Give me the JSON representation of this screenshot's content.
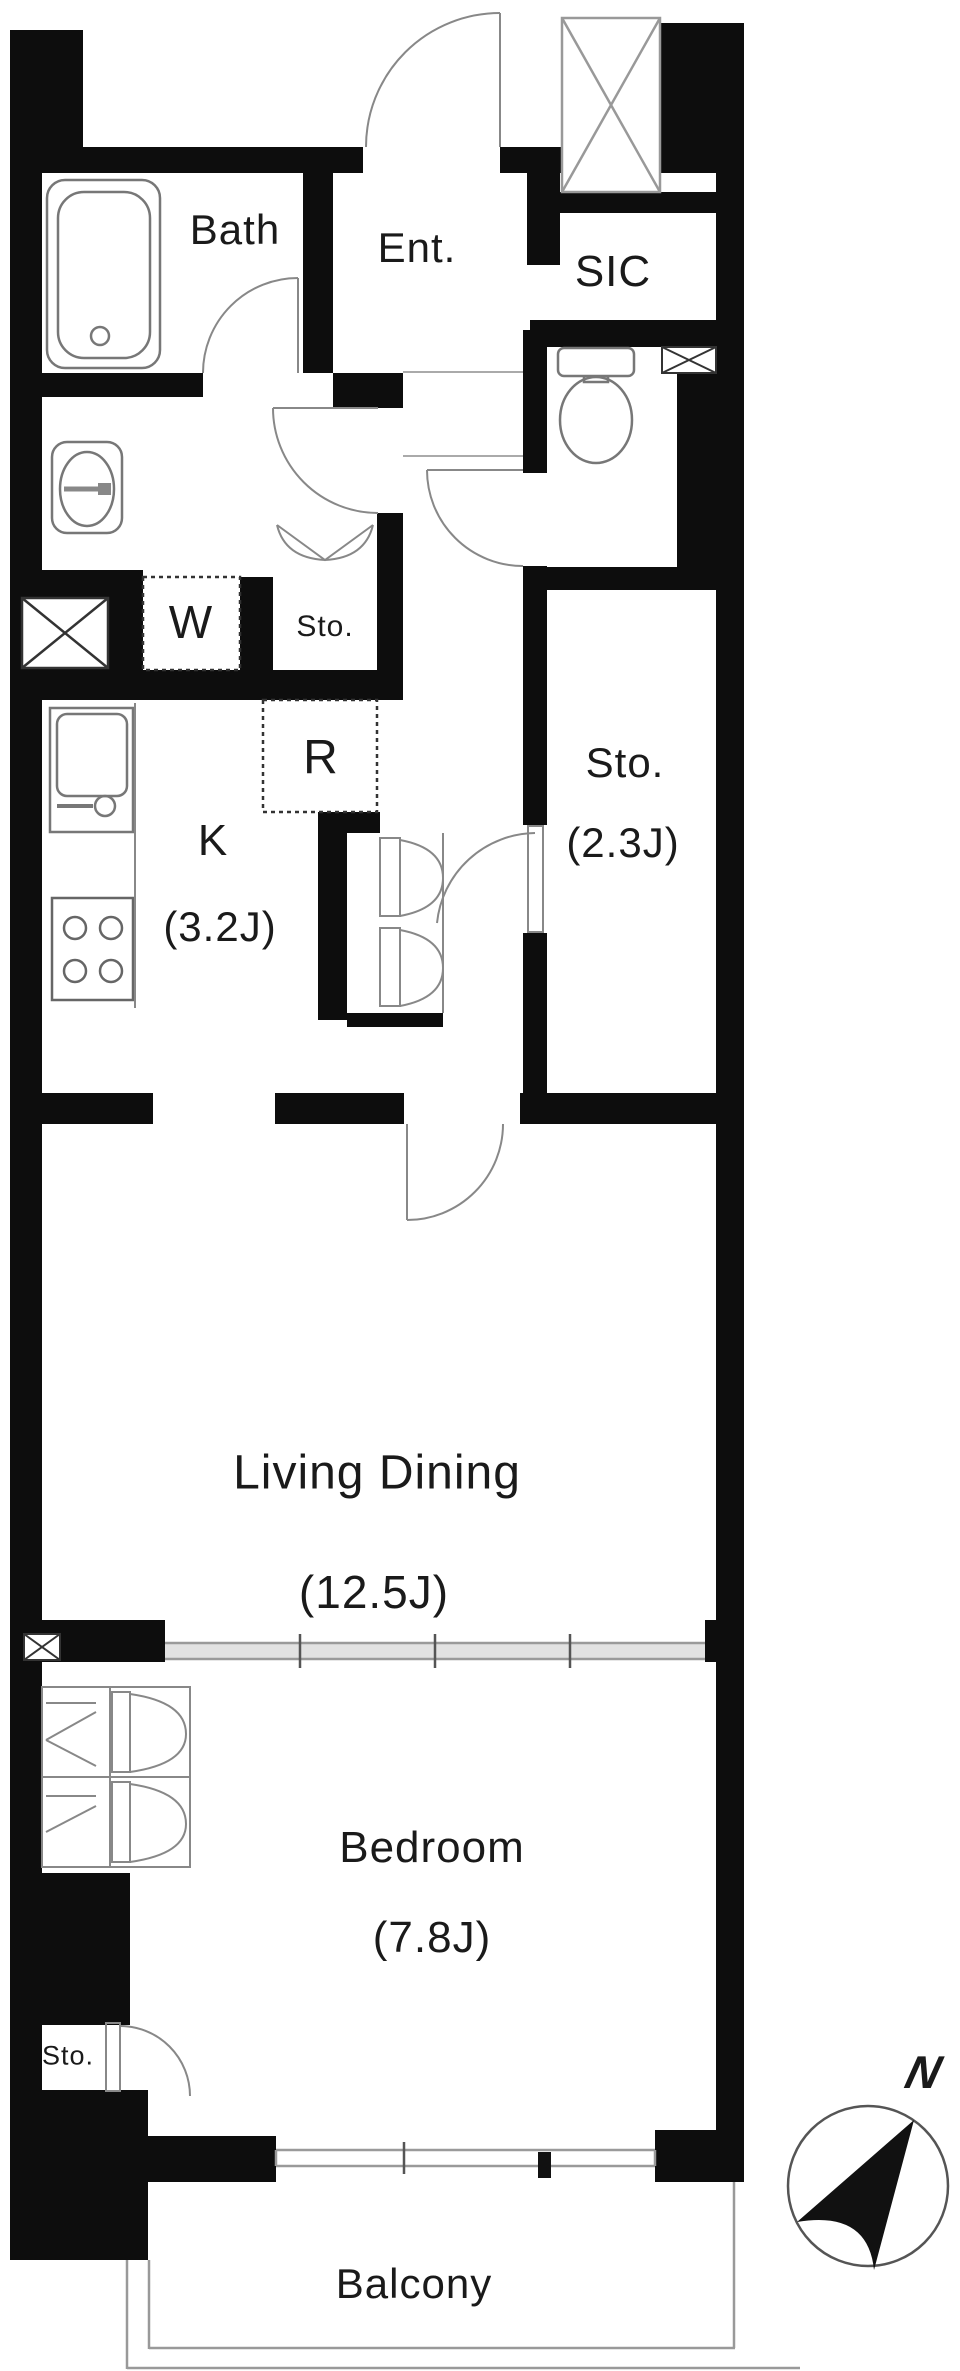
{
  "plan": {
    "title": "1LDK apartment floor plan",
    "rooms": {
      "bath": {
        "label": "Bath"
      },
      "entrance": {
        "label": "Ent."
      },
      "shoe_closet": {
        "label": "SIC"
      },
      "washer_spot": {
        "label": "W"
      },
      "hall_storage": {
        "label": "Sto."
      },
      "fridge_spot": {
        "label": "R"
      },
      "kitchen": {
        "label": "K",
        "size": "(3.2J)"
      },
      "main_storage": {
        "label": "Sto.",
        "size": "(2.3J)"
      },
      "living_dining": {
        "label": "Living Dining",
        "size": "(12.5J)"
      },
      "bedroom": {
        "label": "Bedroom",
        "size": "(7.8J)"
      },
      "bedroom_storage": {
        "label": "Sto."
      },
      "balcony": {
        "label": "Balcony"
      }
    },
    "compass": {
      "label": "N"
    },
    "colors": {
      "wall": "#0d0d0d",
      "line": "#777777",
      "text": "#1a1a1a"
    }
  }
}
